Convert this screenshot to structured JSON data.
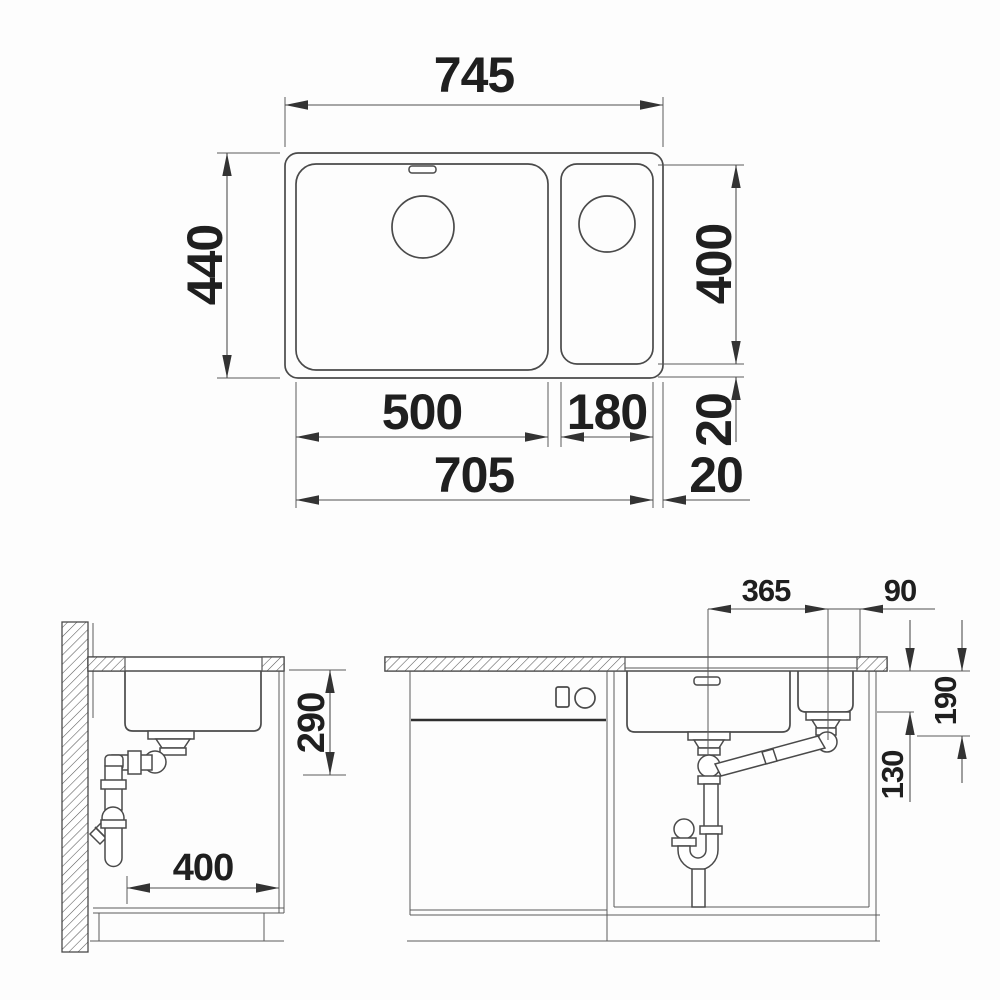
{
  "dimensions": {
    "plan": {
      "overall_width": "745",
      "overall_depth": "440",
      "bowl_depth": "400",
      "rim_right": "20",
      "main_bowl_width": "500",
      "small_bowl_width": "180",
      "bowls_width": "705",
      "rim_bottom": "20"
    },
    "side": {
      "outlet_height": "290",
      "bowl_length": "400"
    },
    "front": {
      "drain_spacing": "365",
      "drain_edge_offset": "90",
      "main_bowl_depth": "190",
      "small_bowl_depth": "130"
    }
  }
}
